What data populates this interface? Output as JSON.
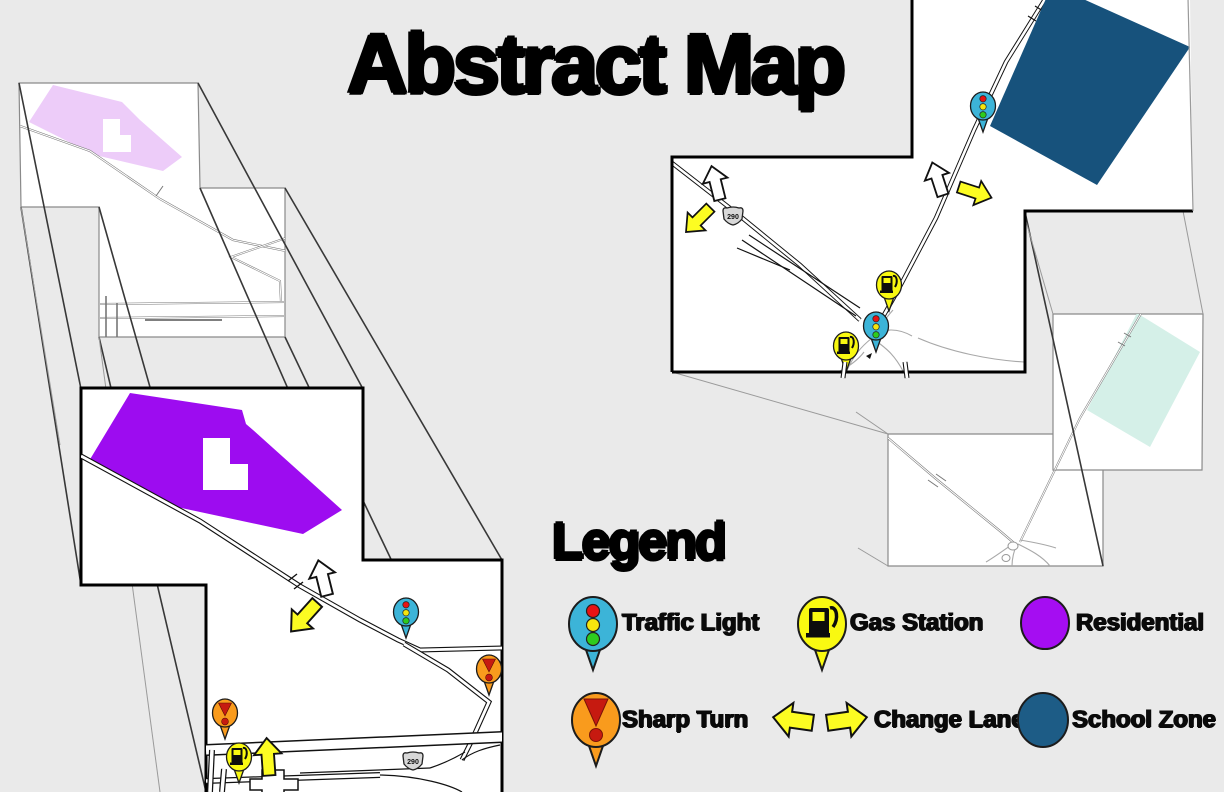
{
  "title": "Abstract Map",
  "legend": {
    "heading": "Legend",
    "items": [
      {
        "label": "Traffic Light",
        "icon": "traffic-light-pin",
        "color": "#3cb4d8"
      },
      {
        "label": "Gas Station",
        "icon": "gas-station-pin",
        "color": "#f9f911"
      },
      {
        "label": "Residential",
        "icon": "residential-swatch",
        "color": "#a50df2"
      },
      {
        "label": "Sharp Turn",
        "icon": "sharp-turn-pin",
        "color": "#f99b1d"
      },
      {
        "label": "Change Lane",
        "icon": "change-lane-arrows",
        "color": "#fcfc22"
      },
      {
        "label": "School Zone",
        "icon": "school-zone-swatch",
        "color": "#1d5c86"
      }
    ]
  },
  "map": {
    "shield_label": "290",
    "colors": {
      "background": "#eaeaea",
      "panel": "#ffffff",
      "residential_detail": "#9d0cf0",
      "residential_overview": "#edccf9",
      "school_zone_detail": "#17527c",
      "school_zone_overview": "#d5f0e8",
      "arrow_yellow": "#fcfc22",
      "traffic_pin": "#3cb4d8",
      "gas_pin": "#f9f911",
      "sharp_pin": "#f99b1d"
    }
  }
}
